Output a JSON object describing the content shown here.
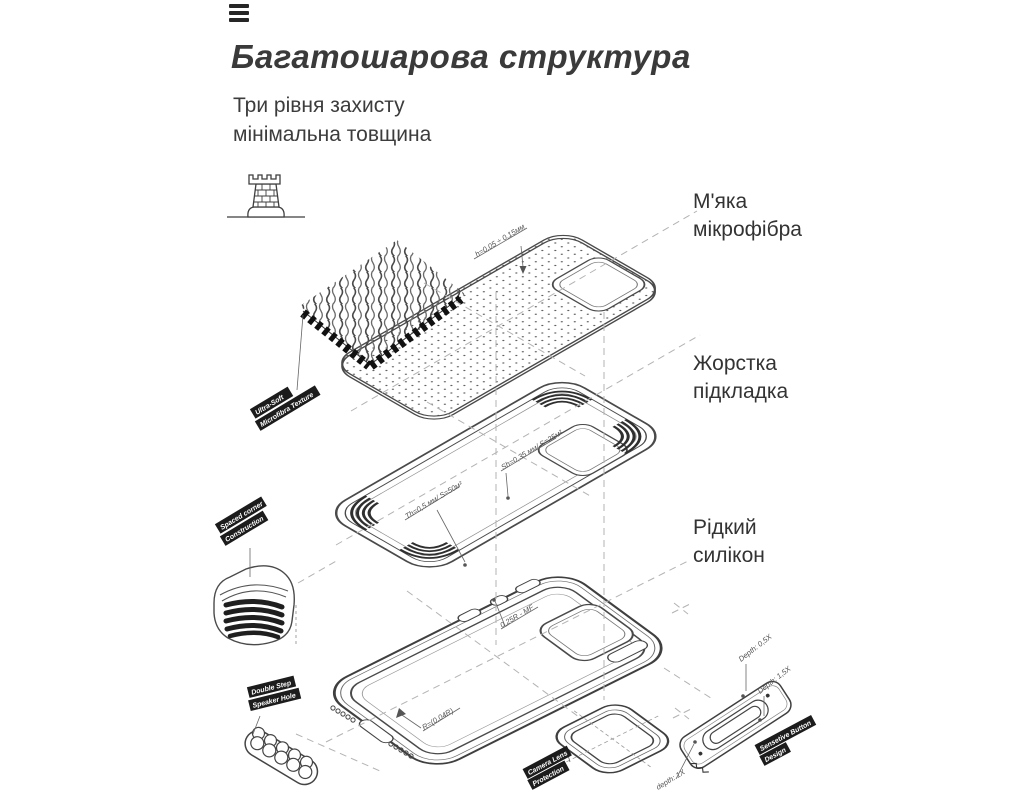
{
  "page": {
    "background": "#ffffff",
    "line_color": "#4a4a4a",
    "ribbon_bg": "#1c1c1c",
    "text_color": "#3a3a3a"
  },
  "header": {
    "menu_icon": "hamburger",
    "title": "Багатошарова структура",
    "subtitle_line1": "Три рівня захисту",
    "subtitle_line2": "мінімальна товщина"
  },
  "layer_labels": [
    {
      "line1": "М'яка",
      "line2": "мікрофібра"
    },
    {
      "line1": "Жорстка",
      "line2": "підкладка"
    },
    {
      "line1": "Рідкий",
      "line2": "силікон"
    }
  ],
  "diagram": {
    "icon": "castle-tower",
    "ribbons": {
      "microfiber": {
        "line1": "Ultra-Soft",
        "line2": "Microfibra Texture"
      },
      "corner": {
        "line1": "Spaced corner",
        "line2": "Construction"
      },
      "speaker": {
        "line1": "Double Step",
        "line2": "Speaker Hole"
      },
      "camera": {
        "line1": "Camera Lens",
        "line2": "Protection"
      },
      "button": {
        "line1": "Sensetive Button",
        "line2": "Design"
      }
    },
    "annotations": {
      "microfiber_thickness": "h=0,05 ÷ 0,15мм",
      "lining_thickness": "Sh=0,35 мм/ S=25м²",
      "lining_thickness2": "Th=0,5 мм/ S=50м²",
      "button_radius": "0,25R - MF",
      "rim_radius": "R=(0,04R)",
      "depth_05": "Depth: 0,5X",
      "depth_15": "Depth: 1,5X",
      "depth_1": "depth: 1X"
    }
  }
}
